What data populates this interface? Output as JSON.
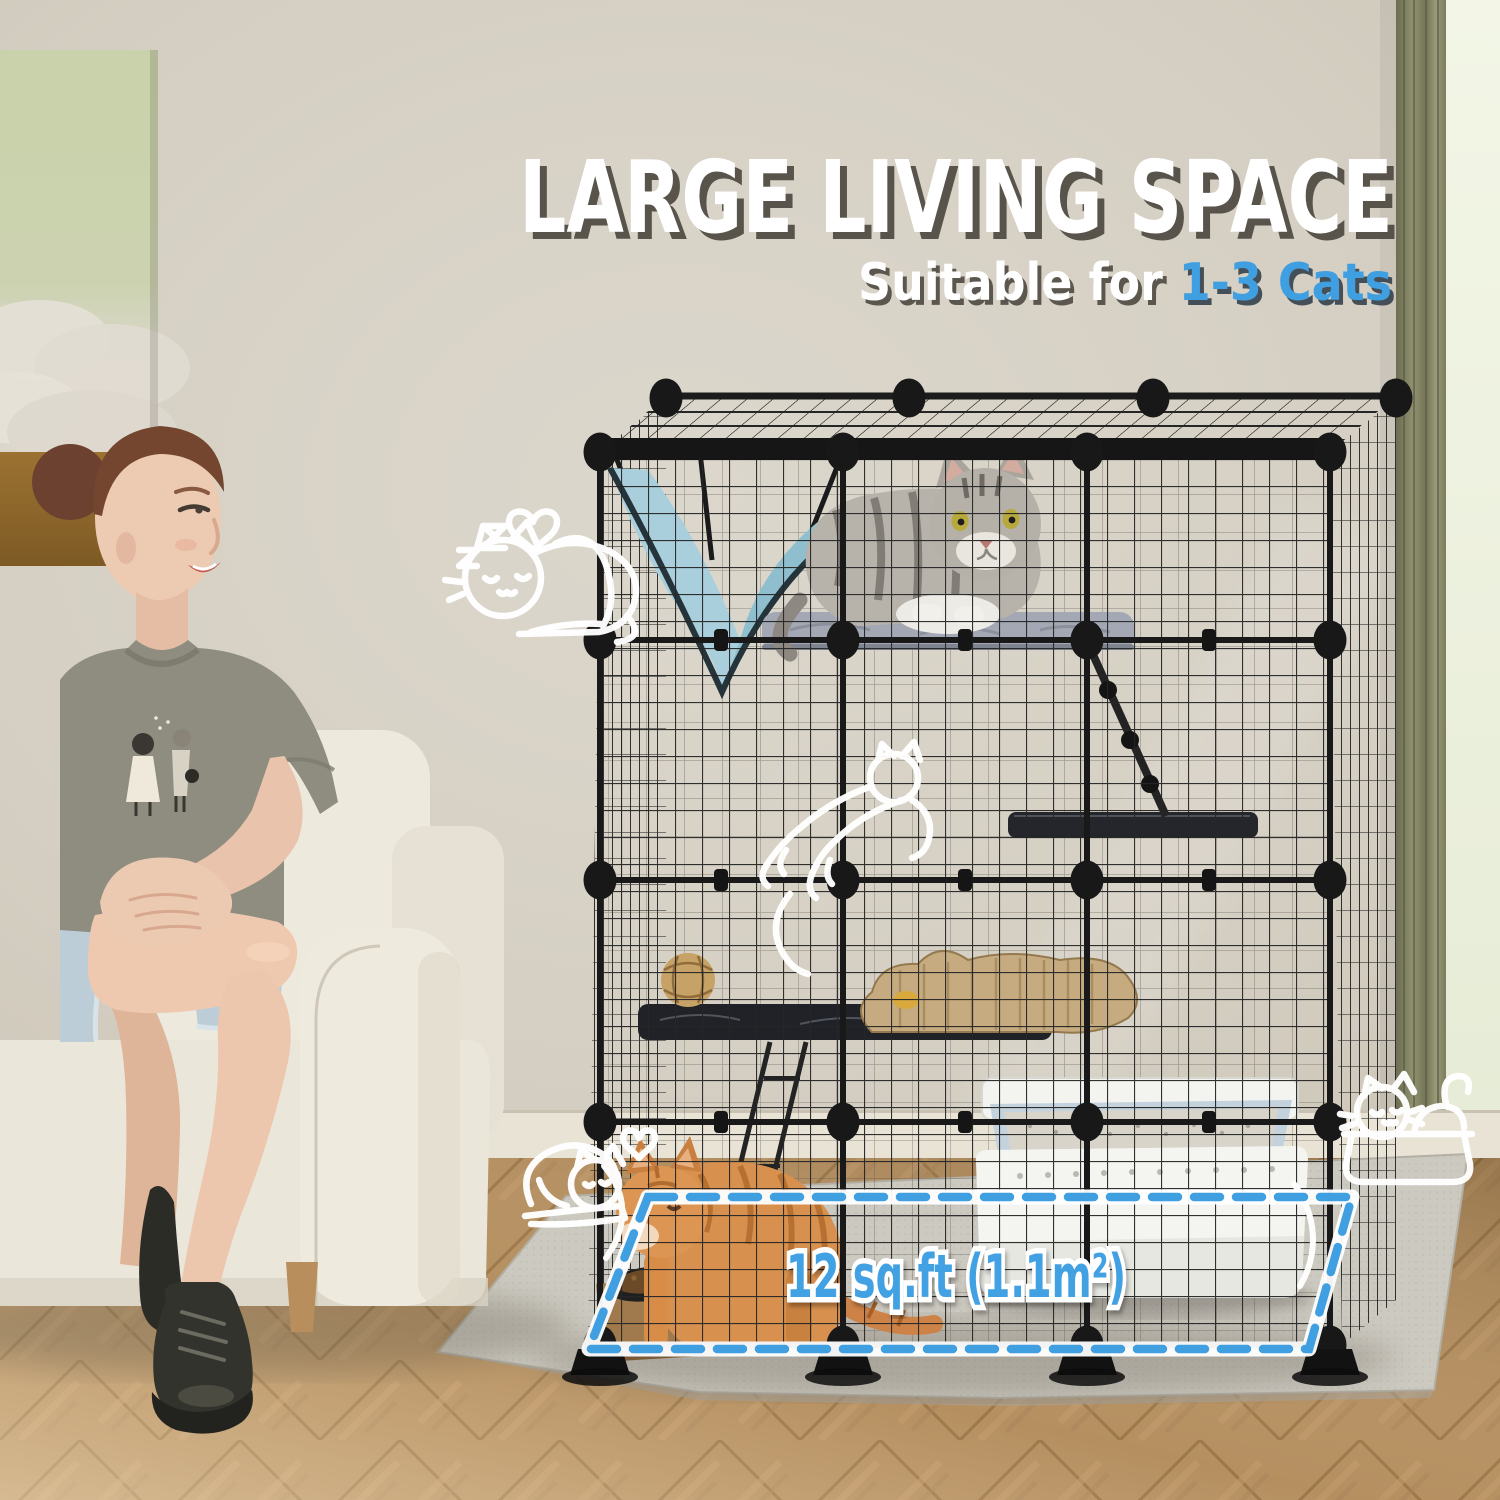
{
  "page": {
    "description": "Product lifestyle photo: modular DIY cat cage (catio), 4 tiers, in a living room; woman seated on cream sofa; cats inside cage; marketing text overlay"
  },
  "headline": {
    "title": "LARGE LIVING SPACE",
    "subtitle_prefix": "Suitable for ",
    "subtitle_highlight": "1-3 Cats"
  },
  "floor_area": {
    "label": "12 sq.ft (1.1m²)"
  },
  "colors": {
    "accent_blue": "#3f9fe0",
    "title_white": "#ffffff",
    "title_shadow": "#4e4a42",
    "wall_beige": "#d7d1c6",
    "wire_black": "#1d1d1d",
    "hammock_blue": "#a9cfdc",
    "rug_gray": "#cbc8bf",
    "wood_floor_tan": "#b58f60",
    "curtain_olive": "#80815f",
    "couch_cream": "#ebe6da",
    "orange_cat": "#d78f4e"
  },
  "doodle_icons": [
    {
      "name": "sleeping-cat-doodle-icon"
    },
    {
      "name": "zzz-icon"
    },
    {
      "name": "heart-icon"
    },
    {
      "name": "arrow-swoosh-icon"
    },
    {
      "name": "jumping-cat-doodle-icon"
    },
    {
      "name": "basket-cats-doodle-icon"
    },
    {
      "name": "curled-cat-doodle-icon"
    }
  ],
  "scene": {
    "cage": {
      "tiers": 4,
      "panels_wide": 3,
      "visible_contents": [
        "blue hammock",
        "gray tabby cat on platform",
        "wicker ball toy",
        "cat-shaped scratcher",
        "wire ladder",
        "climbing ramp",
        "white litter box",
        "orange cat",
        "raised food bowls on wood stand"
      ]
    },
    "room_items": [
      "green cloud wall art",
      "olive curtain with window light",
      "cream boucle sofa",
      "gray rug",
      "herringbone wood floor"
    ],
    "people": [
      "woman with hair bun seated on sofa"
    ]
  }
}
